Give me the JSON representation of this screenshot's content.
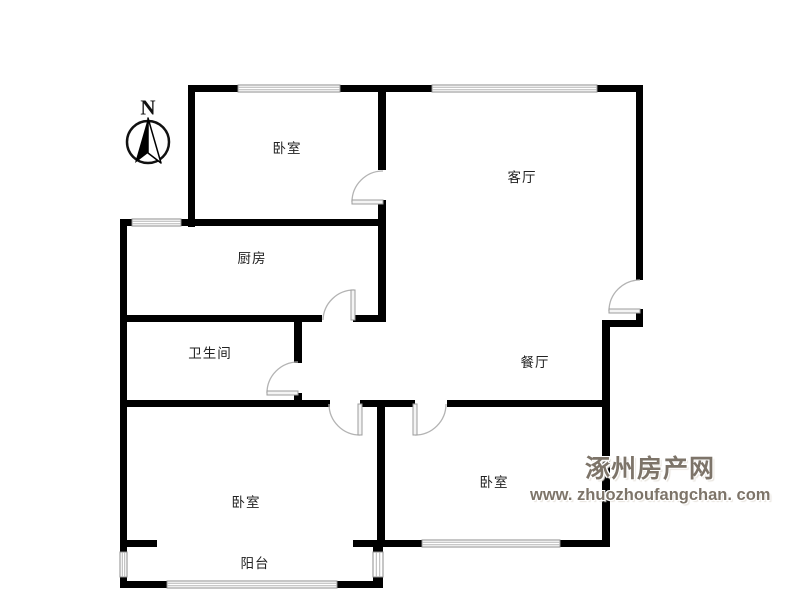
{
  "compass": {
    "label": "N"
  },
  "rooms": [
    {
      "name": "bedroom-north",
      "label": "卧室"
    },
    {
      "name": "living-room",
      "label": "客厅"
    },
    {
      "name": "kitchen",
      "label": "厨房"
    },
    {
      "name": "bathroom",
      "label": "卫生间"
    },
    {
      "name": "dining-room",
      "label": "餐厅"
    },
    {
      "name": "bedroom-southwest",
      "label": "卧室"
    },
    {
      "name": "bedroom-southeast",
      "label": "卧室"
    },
    {
      "name": "balcony",
      "label": "阳台"
    }
  ],
  "watermark": {
    "site_name": "涿州房产网",
    "url": "www. zhuozhoufangchan. com",
    "color": "#7d7469"
  },
  "colors": {
    "wall": "#000000",
    "door_arc": "#b3b3b3",
    "window_stripe": "#b5b5b5",
    "background": "#ffffff",
    "label_text": "#222222"
  }
}
